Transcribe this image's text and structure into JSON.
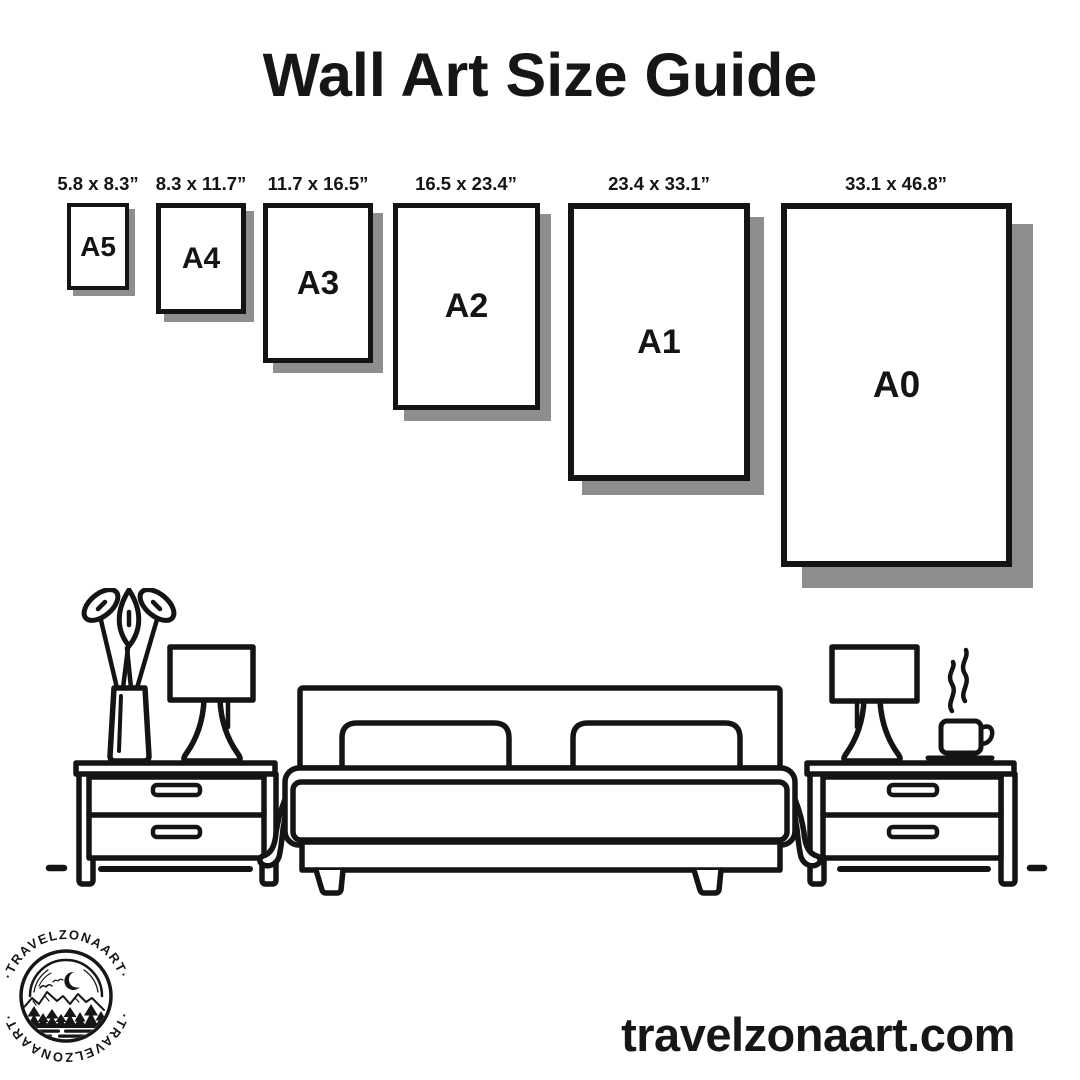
{
  "title": "Wall Art Size Guide",
  "size_guide": {
    "items": [
      {
        "name": "A5",
        "dimensions": "5.8 x 8.3”"
      },
      {
        "name": "A4",
        "dimensions": "8.3 x 11.7”"
      },
      {
        "name": "A3",
        "dimensions": "11.7 x 16.5”"
      },
      {
        "name": "A2",
        "dimensions": "16.5 x 23.4”"
      },
      {
        "name": "A1",
        "dimensions": "23.4 x 33.1”"
      },
      {
        "name": "A0",
        "dimensions": "33.1 x 46.8”"
      }
    ]
  },
  "logo": {
    "text_top": "·TRAVELZONAART·",
    "text_bottom": "·TRAVELZONAART·"
  },
  "footer": {
    "website": "travelzonaart.com"
  },
  "scene": {
    "icons": [
      "plant-icon",
      "lamp-icon",
      "nightstand-icon",
      "bed-icon",
      "pillow-icon",
      "coffee-cup-icon"
    ]
  },
  "colors": {
    "ink": "#161616",
    "frame_shadow": "#8e8e8e",
    "background": "#ffffff"
  }
}
